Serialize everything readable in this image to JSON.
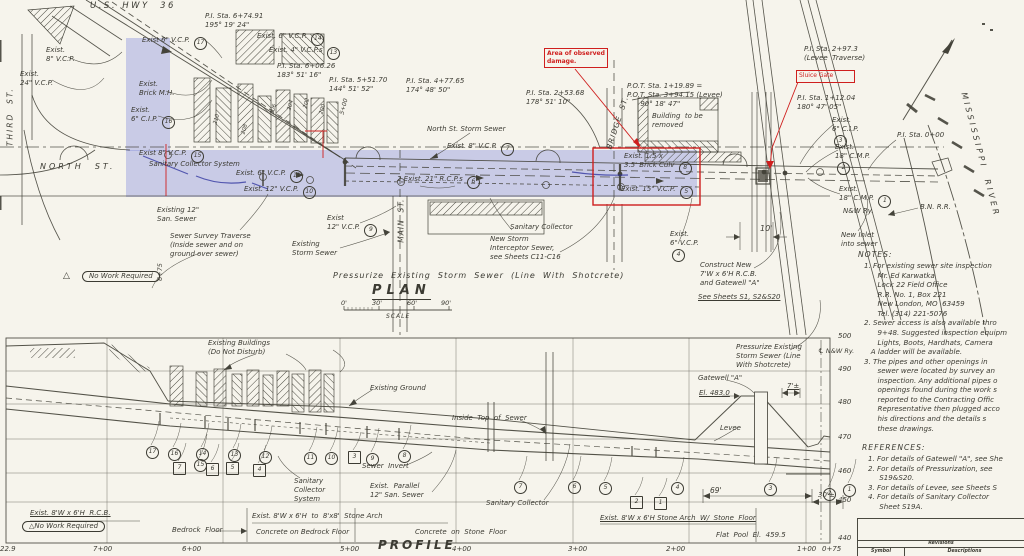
{
  "palette": {
    "paper": "#f6f4ec",
    "ink": "#44433a",
    "highlight_blue": "#8289de",
    "pen_blue": "#2a2f9c",
    "annotation_red": "#cf1f1e"
  },
  "plan": {
    "title": "PLAN",
    "scale_caption": "SCALE"
  },
  "profile": {
    "title": "PROFILE"
  },
  "annotations": {
    "damage": "Area of observed\ndamage.",
    "sluice": "Sluice Gate"
  },
  "notes": {
    "title": "NOTES:",
    "body": "1. For existing sewer site inspection\n      Mr. Ed Karwatka\n      Lock 22 Field Office\n      R.R. No. 1, Box 221\n      New London, MO  63459\n      Tel. (314) 221-5076\n2. Sewer access is also available thro\n      9+48. Suggested inspection equipm\n      Lights, Boots, Hardhats, Camera\n   A ladder will be available.\n3. The pipes and other openings in\n      sewer were located by survey an\n      inspection. Any additional pipes o\n      openings found during the work s\n      reported to the Contracting Offic\n      Representative then plugged acco\n      his directions and the details s\n      these drawings."
  },
  "references": {
    "title": "REFERENCES:",
    "body": "1. For details of Gatewell \"A\", see She\n2. For details of Pressurization, see\n     S19&S20.\n3. For details of Levee, see Sheets S\n4. For details of Sanitary Collector\n     Sheet S19A."
  },
  "titleblock": {
    "revisions": "Revisions",
    "symbol": "Symbol",
    "descriptions": "Descriptions"
  },
  "labels": [
    {
      "n": "us-hwy-36-label",
      "t": "U.S. HWY  36",
      "x": 90,
      "y": 1,
      "s": 8.5,
      "sp": 2.5
    },
    {
      "n": "third-st-label",
      "t": "THIRD  ST.",
      "x": -25,
      "y": 112,
      "w": 70,
      "r": -90,
      "s": 7.5,
      "sp": 2,
      "ta": "center"
    },
    {
      "n": "north-st-label",
      "t": "NORTH  ST.",
      "x": 40,
      "y": 162,
      "s": 8,
      "sp": 3
    },
    {
      "n": "exist-8in-vcp-label",
      "t": "Exist.\n8\" V.C.P.",
      "x": 46,
      "y": 46
    },
    {
      "n": "exist-24in-vcp-label",
      "t": "Exist.\n24\" V.C.P.",
      "x": 20,
      "y": 70
    },
    {
      "n": "pi-sta-674-label",
      "t": "P.I. Sta. 6+74.91\n195° 19' 24\"",
      "x": 205,
      "y": 12
    },
    {
      "n": "exist-6in-vcp-17-label",
      "t": "Exist 6\" V.C.P. ",
      "num": 17,
      "x": 142,
      "y": 36
    },
    {
      "n": "exist-6in-vcp-14-label",
      "t": "Exist. 6\" V.C.P. ",
      "num": 14,
      "x": 257,
      "y": 32
    },
    {
      "n": "exist-4in-vcps-13-label",
      "t": "Exist. 4\" V.C.P.s ",
      "num": 13,
      "x": 269,
      "y": 46
    },
    {
      "n": "pi-sta-606-label",
      "t": "P.I. Sta. 6+06.26\n183° 51' 16\"",
      "x": 277,
      "y": 62
    },
    {
      "n": "pi-sta-551-label",
      "t": "P.I. Sta. 5+51.70\n144° 51' 52\"",
      "x": 329,
      "y": 76
    },
    {
      "n": "pi-sta-477-label",
      "t": "P.I. Sta. 4+77.65\n174° 48' 50\"",
      "x": 406,
      "y": 77
    },
    {
      "n": "exist-brick-mh-label",
      "t": "Exist.\nBrick M.H.",
      "x": 139,
      "y": 80
    },
    {
      "n": "exist-6in-cip-16-label",
      "t": "Exist.\n6\" C.I.P. ",
      "num": 16,
      "x": 131,
      "y": 106
    },
    {
      "n": "exist-8in-vcp-15-label",
      "t": "Exist 8\" V.C.P. ",
      "num": 15,
      "x": 139,
      "y": 149
    },
    {
      "n": "sanitary-collector-system-plan-label",
      "t": "Sanitary Collector System",
      "x": 149,
      "y": 160
    },
    {
      "n": "exist-6in-vcp-11-label",
      "t": "Exist. 6\" V.C.P. ",
      "num": 11,
      "x": 236,
      "y": 169
    },
    {
      "n": "exist-12in-vcp-10-label",
      "t": "Exist. 12\" V.C.P. ",
      "num": 10,
      "x": 244,
      "y": 185
    },
    {
      "n": "existing-12in-san-sewer-label",
      "t": "Existing 12\"\nSan. Sewer",
      "x": 157,
      "y": 206
    },
    {
      "n": "sewer-survey-traverse-label",
      "t": "Sewer Survey Traverse\n(Inside sewer and on\nground over sewer)",
      "x": 170,
      "y": 232
    },
    {
      "n": "existing-storm-sewer-label",
      "t": "Existing\nStorm Sewer",
      "x": 292,
      "y": 240
    },
    {
      "n": "north-st-storm-sewer-label",
      "t": "North St. Storm Sewer",
      "x": 427,
      "y": 125
    },
    {
      "n": "exist-8in-vcp-7-label",
      "t": "Exist. 8\" V.C.P. ",
      "num": 7,
      "x": 447,
      "y": 142
    },
    {
      "n": "exist-21in-rcps-6-label",
      "t": "2 Exist. 21\" R.C.P.s ",
      "num": 6,
      "x": 397,
      "y": 175
    },
    {
      "n": "exist-12in-vcp-9-label",
      "t": "Exist\n12\" V.C.P. ",
      "num": 9,
      "x": 327,
      "y": 214
    },
    {
      "n": "main-st-label",
      "t": "MAIN  ST.",
      "x": 371,
      "y": 216,
      "r": -90,
      "w": 60,
      "ta": "center",
      "s": 7.5,
      "sp": 1
    },
    {
      "n": "sanitary-collector-mid-label",
      "t": "Sanitary Collector",
      "x": 510,
      "y": 223
    },
    {
      "n": "new-storm-interceptor-label",
      "t": "New Storm\nInterceptor Sewer,\nsee Sheets C11-C16",
      "x": 490,
      "y": 235
    },
    {
      "n": "exist-6in-vcp-4-label",
      "t": "Exist.\n6\" V.C.P.\n",
      "num": 4,
      "x": 670,
      "y": 230
    },
    {
      "n": "pressurize-main-label",
      "t": "Pressurize  Existing  Storm  Sewer  (Line  With  Shotcrete)",
      "x": 333,
      "y": 271,
      "s": 8,
      "sp": 1
    },
    {
      "n": "pot-sta-label",
      "t": "P.O.T. Sta. 1+19.89 =\nP.O.T. Sta. 3+94.15 (Levee)\n      90° 18' 47\"",
      "x": 627,
      "y": 82
    },
    {
      "n": "building-to-be-removed-label",
      "t": "Building  to be\nremoved",
      "x": 652,
      "y": 112
    },
    {
      "n": "bridge-st-label",
      "t": "BRIDGE  ST.",
      "x": 580,
      "y": 118,
      "r": -72,
      "w": 75,
      "ta": "center",
      "s": 7.5,
      "sp": 1
    },
    {
      "n": "exist-brick-culv-8-label",
      "t": "Exist. 1.5 x\n3.5' Brick Culv ",
      "num": 8,
      "x": 624,
      "y": 152
    },
    {
      "n": "exist-15in-vcp-5-label",
      "t": "Exist. 15\" V.C.P. ",
      "num": 5,
      "x": 621,
      "y": 185
    },
    {
      "n": "pi-sta-253-label",
      "t": "P.I. Sta. 2+53.68\n178° 51' 10\"",
      "x": 526,
      "y": 89
    },
    {
      "n": "pi-sta-297-label",
      "t": "P.I. Sta. 2+97.3\n(Levee  Traverse)",
      "x": 804,
      "y": 45
    },
    {
      "n": "pi-sta-112-label",
      "t": "P.I. Sta. 1+12.04\n180° 47' 05\"",
      "x": 797,
      "y": 94
    },
    {
      "n": "exist-6in-cip-3-label",
      "t": "Exist.\n6\" C.I.P.\n",
      "num": 3,
      "x": 832,
      "y": 116
    },
    {
      "n": "exist-18in-cmp-2-label",
      "t": "Exist.\n18\" C.M.P.\n",
      "num": 2,
      "x": 835,
      "y": 143
    },
    {
      "n": "pi-sta-000-label",
      "t": "P.I. Sta. 0+00",
      "x": 897,
      "y": 131
    },
    {
      "n": "exist-18in-cmp-1-label",
      "t": "Exist.\n18\" C.M.P. ",
      "num": 1,
      "x": 839,
      "y": 185
    },
    {
      "n": "nw-ry-label",
      "t": "N&W Ry.",
      "x": 843,
      "y": 207
    },
    {
      "n": "bn-rr-label",
      "t": "B.N. R.R.",
      "x": 920,
      "y": 203
    },
    {
      "n": "new-inlet-label",
      "t": "New Inlet\ninto sewer",
      "x": 841,
      "y": 231
    },
    {
      "n": "mississippi-river-label",
      "t": "MISSISSIPPI  RIVER",
      "x": 905,
      "y": 150,
      "r": 75,
      "w": 150,
      "ta": "center",
      "s": 8,
      "sp": 3
    },
    {
      "n": "dim-10ft-label",
      "t": "10'",
      "x": 760,
      "y": 224,
      "s": 8
    },
    {
      "n": "construct-new-label",
      "t": "Construct New\n7'W x 6'H R.C.B.\nand Gatewell \"A\"",
      "x": 700,
      "y": 261
    },
    {
      "n": "see-sheets-label",
      "t": "See Sheets S1, S2&S20",
      "x": 698,
      "y": 293,
      "u": 1
    },
    {
      "n": "pressurize-2-label",
      "t": "Pressurize Existing\nStorm Sewer (Line\nWith Shotcrete)",
      "x": 736,
      "y": 343
    },
    {
      "n": "warn-triangle-plan",
      "t": "△",
      "x": 63,
      "y": 271,
      "s": 9
    },
    {
      "n": "no-work-required-plan-label",
      "t": "No Work Required",
      "x": 82,
      "y": 271,
      "c": "oval"
    },
    {
      "n": "sta-675-marker-label",
      "t": "6+75",
      "x": 146,
      "y": 268,
      "r": -90,
      "w": 28,
      "ta": "center",
      "s": 6.5
    },
    {
      "n": "bldg-210-label",
      "t": "210",
      "x": 212,
      "y": 116,
      "r": -75,
      "s": 5.5
    },
    {
      "n": "bldg-208-label",
      "t": "208",
      "x": 240,
      "y": 126,
      "r": -75,
      "s": 5.5
    },
    {
      "n": "bldg-206-label",
      "t": "206",
      "x": 269,
      "y": 106,
      "r": -75,
      "s": 5.5
    },
    {
      "n": "bldg-204-label",
      "t": "204",
      "x": 286,
      "y": 102,
      "r": -75,
      "s": 5.5
    },
    {
      "n": "bldg-202-label",
      "t": "202",
      "x": 302,
      "y": 100,
      "r": -75,
      "s": 5.5
    },
    {
      "n": "bldg-200-label",
      "t": "200",
      "x": 318,
      "y": 106,
      "r": -75,
      "s": 5.5
    },
    {
      "n": "sta-500-plan-label",
      "t": "5+00",
      "x": 336,
      "y": 103,
      "r": -75,
      "s": 6
    },
    {
      "n": "scale-tick-0",
      "t": "0'",
      "x": 341,
      "y": 299,
      "s": 6.5
    },
    {
      "n": "scale-tick-30",
      "t": "30'",
      "x": 372,
      "y": 299,
      "s": 6.5
    },
    {
      "n": "scale-tick-60",
      "t": "60'",
      "x": 407,
      "y": 299,
      "s": 6.5
    },
    {
      "n": "scale-tick-90",
      "t": "90'",
      "x": 441,
      "y": 299,
      "s": 6.5
    },
    {
      "n": "existing-buildings-label",
      "t": "Existing Buildings\n(Do Not Disturb)",
      "x": 208,
      "y": 339
    },
    {
      "n": "existing-ground-label",
      "t": "Existing Ground",
      "x": 370,
      "y": 384
    },
    {
      "n": "inside-top-of-sewer-label",
      "t": "Inside  Top  of  Sewer",
      "x": 452,
      "y": 414
    },
    {
      "n": "sewer-invert-label",
      "t": "Sewer  Invert",
      "x": 362,
      "y": 462
    },
    {
      "n": "sanitary-collector-system-profile-label",
      "t": "Sanitary\nCollector\nSystem",
      "x": 294,
      "y": 477
    },
    {
      "n": "exist-parallel-san-sewer-label",
      "t": "Exist.  Parallel\n12\" San. Sewer",
      "x": 370,
      "y": 482
    },
    {
      "n": "sanitary-collector-profile-label",
      "t": "Sanitary Collector",
      "x": 486,
      "y": 499
    },
    {
      "n": "gatewell-a-label",
      "t": "Gatewell \"A\"",
      "x": 698,
      "y": 374
    },
    {
      "n": "el-483-label",
      "t": "El. 483.0",
      "x": 699,
      "y": 389,
      "u": 1
    },
    {
      "n": "levee-label",
      "t": "Levee",
      "x": 720,
      "y": 424
    },
    {
      "n": "dim-7ft-label",
      "t": "7'±",
      "x": 787,
      "y": 382,
      "u": 1
    },
    {
      "n": "dim-69ft-label",
      "t": "69'",
      "x": 710,
      "y": 486,
      "s": 7.5
    },
    {
      "n": "dim-30ft-label",
      "t": "30'±",
      "x": 818,
      "y": 491,
      "s": 7
    },
    {
      "n": "exist-rcb-label",
      "t": "Exist. 8'W x 6'H  R.C.B.",
      "x": 30,
      "y": 509,
      "u": 1
    },
    {
      "n": "no-work-required-profile-label",
      "t": "△No Work Required",
      "x": 22,
      "y": 521,
      "c": "oval"
    },
    {
      "n": "bedrock-floor-label",
      "t": "Bedrock  Floor",
      "x": 172,
      "y": 526
    },
    {
      "n": "exist-to-stone-arch-label",
      "t": "Exist. 8'W x 6'H  to  8'x8'  Stone Arch",
      "x": 252,
      "y": 512
    },
    {
      "n": "concrete-bedrock-floor-label",
      "t": "Concrete on Bedrock Floor",
      "x": 256,
      "y": 528
    },
    {
      "n": "concrete-stone-floor-label",
      "t": "Concrete  on  Stone  Floor",
      "x": 415,
      "y": 528
    },
    {
      "n": "exist-stone-arch-label",
      "t": "Exist. 8'W x 6'H Stone Arch  W/  Stone  Floor",
      "x": 600,
      "y": 514,
      "u": 1
    },
    {
      "n": "flat-pool-label",
      "t": "Flat  Pool  El.  459.5",
      "x": 716,
      "y": 531
    },
    {
      "n": "cl-nw-ry-label",
      "t": "℄ N&W Ry.",
      "x": 818,
      "y": 347,
      "s": 6.5
    },
    {
      "n": "elev-500",
      "t": "500",
      "x": 838,
      "y": 332,
      "s": 7
    },
    {
      "n": "elev-490",
      "t": "490",
      "x": 838,
      "y": 365,
      "s": 7
    },
    {
      "n": "elev-480",
      "t": "480",
      "x": 838,
      "y": 398,
      "s": 7
    },
    {
      "n": "elev-470",
      "t": "470",
      "x": 838,
      "y": 433,
      "s": 7
    },
    {
      "n": "elev-460",
      "t": "460",
      "x": 838,
      "y": 467,
      "s": 7
    },
    {
      "n": "elev-450",
      "t": "450",
      "x": 838,
      "y": 496,
      "s": 7
    },
    {
      "n": "elev-440",
      "t": "440",
      "x": 838,
      "y": 534,
      "s": 7
    },
    {
      "n": "sta-229",
      "t": "22.9",
      "x": 0,
      "y": 545,
      "s": 7
    },
    {
      "n": "sta-700",
      "t": "7+00",
      "x": 93,
      "y": 545,
      "s": 7
    },
    {
      "n": "sta-600",
      "t": "6+00",
      "x": 182,
      "y": 545,
      "s": 7
    },
    {
      "n": "sta-500",
      "t": "5+00",
      "x": 340,
      "y": 545,
      "s": 7
    },
    {
      "n": "sta-400",
      "t": "4+00",
      "x": 452,
      "y": 545,
      "s": 7
    },
    {
      "n": "sta-300",
      "t": "3+00",
      "x": 568,
      "y": 545,
      "s": 7
    },
    {
      "n": "sta-200",
      "t": "2+00",
      "x": 666,
      "y": 545,
      "s": 7
    },
    {
      "n": "sta-100",
      "t": "1+00",
      "x": 797,
      "y": 545,
      "s": 7
    },
    {
      "n": "sta-075",
      "t": "0+75",
      "x": 822,
      "y": 545,
      "s": 7
    }
  ],
  "markers": {
    "circles": [
      [
        17,
        146,
        446
      ],
      [
        16,
        168,
        448
      ],
      [
        14,
        196,
        448
      ],
      [
        15,
        194,
        459
      ],
      [
        13,
        228,
        449
      ],
      [
        12,
        259,
        451
      ],
      [
        11,
        304,
        452
      ],
      [
        10,
        325,
        452
      ],
      [
        9,
        366,
        453
      ],
      [
        8,
        398,
        450
      ],
      [
        7,
        514,
        481
      ],
      [
        6,
        568,
        481
      ],
      [
        5,
        599,
        482
      ],
      [
        4,
        671,
        482
      ],
      [
        3,
        764,
        483
      ],
      [
        2,
        823,
        488
      ],
      [
        1,
        843,
        484
      ]
    ],
    "squares": [
      [
        7,
        173,
        462
      ],
      [
        6,
        206,
        463
      ],
      [
        5,
        226,
        462
      ],
      [
        4,
        253,
        464
      ],
      [
        3,
        348,
        451
      ],
      [
        2,
        630,
        496
      ],
      [
        1,
        654,
        497
      ]
    ]
  }
}
